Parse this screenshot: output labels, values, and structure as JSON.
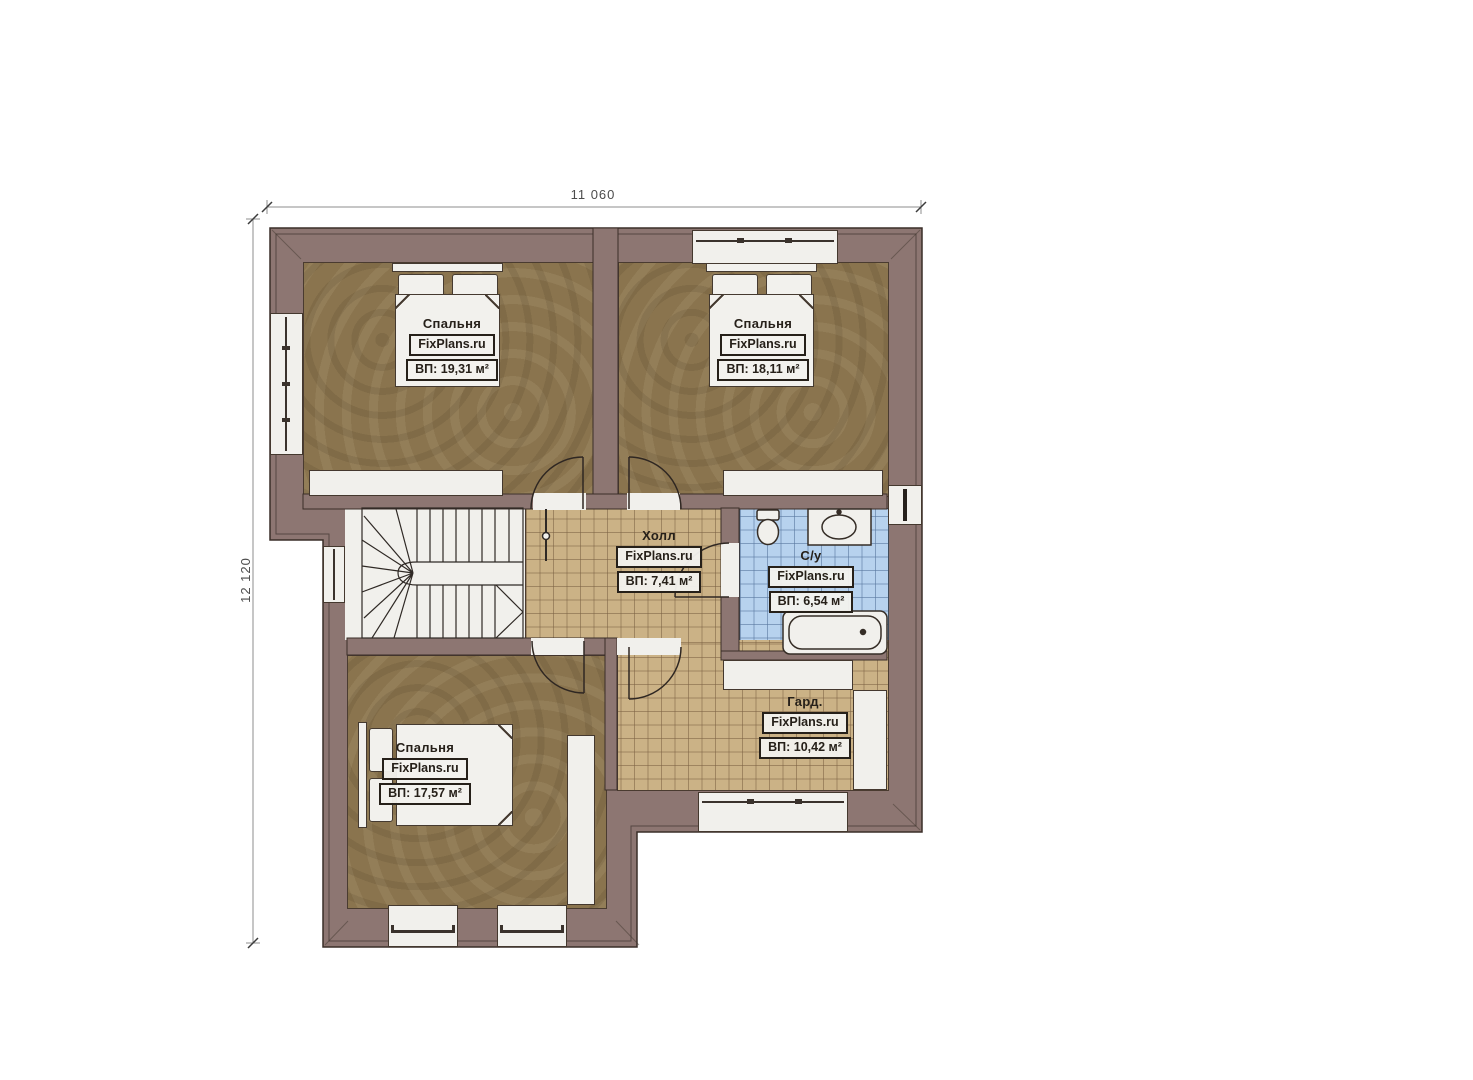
{
  "plan_title": "Second floor plan",
  "watermark": "FixPlans.ru",
  "dimensions": {
    "top": "11 060",
    "left": "12 120"
  },
  "rooms": [
    {
      "name": "Спальня",
      "area": "ВП: 19,31 м²"
    },
    {
      "name": "Спальня",
      "area": "ВП: 18,11 м²"
    },
    {
      "name": "Холл",
      "area": "ВП: 7,41 м²"
    },
    {
      "name": "С/у",
      "area": "ВП: 6,54 м²"
    },
    {
      "name": "Спальня",
      "area": "ВП: 17,57 м²"
    },
    {
      "name": "Гард.",
      "area": "ВП: 10,42 м²"
    }
  ],
  "colors": {
    "wall": "#8d7672",
    "bedroom_floor": "#8a744e",
    "tile_tan": "#cbb286",
    "tile_blue": "#b7d2ee",
    "white_fill": "#f1f0ec",
    "line_ink": "#3a2e28"
  }
}
